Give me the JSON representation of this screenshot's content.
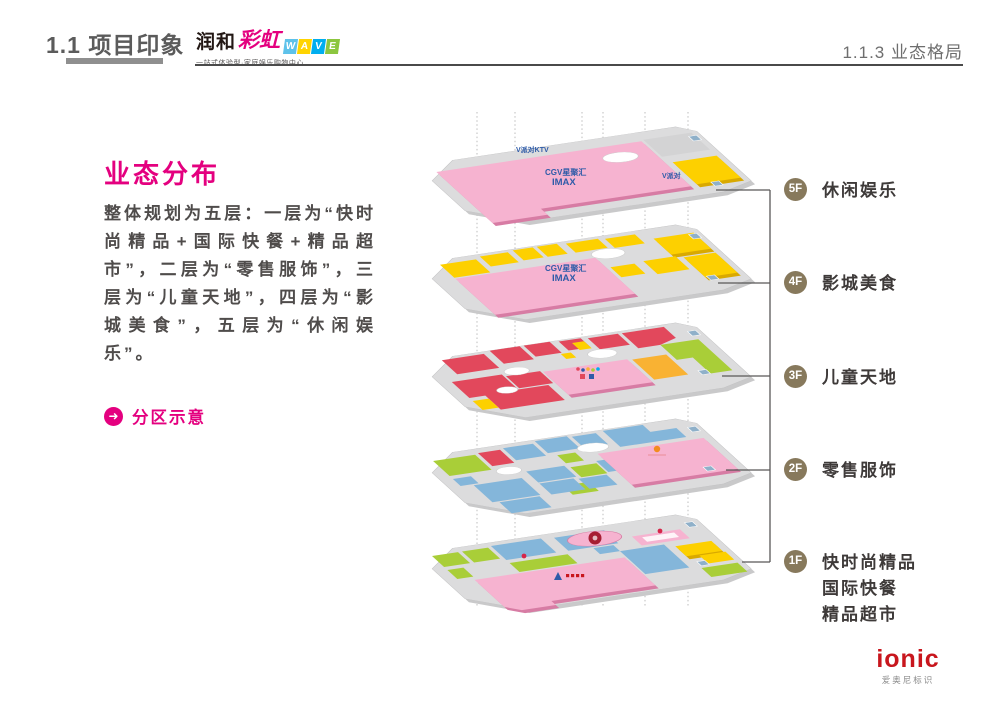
{
  "header": {
    "section_title": "1.1 项目印象",
    "page_title": "1.1.3 业态格局",
    "logo": {
      "name_cn": "润和",
      "name_script": "彩虹",
      "name_latin_letters": [
        "W",
        "A",
        "V",
        "E"
      ],
      "tagline": "一站式体验型·家庭娱乐购物中心"
    }
  },
  "left_panel": {
    "heading": "业态分布",
    "paragraph": "整体规划为五层：一层为“快时尚精品+国际快餐+精品超市”，二层为“零售服饰”，三层为“儿童天地”，四层为“影城美食”，五层为“休闲娱乐”。",
    "link_label": "分区示意",
    "link_icon": "arrow-right-circle-icon"
  },
  "floors": [
    {
      "badge": "5F",
      "label_lines": [
        "休闲娱乐"
      ]
    },
    {
      "badge": "4F",
      "label_lines": [
        "影城美食"
      ]
    },
    {
      "badge": "3F",
      "label_lines": [
        "儿童天地"
      ]
    },
    {
      "badge": "2F",
      "label_lines": [
        "零售服饰"
      ]
    },
    {
      "badge": "1F",
      "label_lines": [
        "快时尚精品",
        "国际快餐",
        "精品超市"
      ]
    }
  ],
  "diagram": {
    "brands": {
      "ktv": "V派对KTV",
      "ktv_short": "V派对",
      "cinema_name": "CGV星聚汇",
      "cinema_format": "IMAX"
    },
    "colors": {
      "accent_magenta": "#E4007F",
      "floor_plate_gray": "#DCDCDD",
      "zone_pink": "#F6B3D0",
      "zone_yellow": "#FDD000",
      "zone_red": "#E2485C",
      "zone_blue": "#84B6DA",
      "zone_green": "#A9CE38",
      "zone_orange": "#F9B233",
      "badge_brown": "#87795C",
      "brand_blue": "#2E5BA8",
      "ionic_red": "#C8161D"
    }
  },
  "footer": {
    "brand": "ionic",
    "caption": "爱奥尼标识"
  }
}
